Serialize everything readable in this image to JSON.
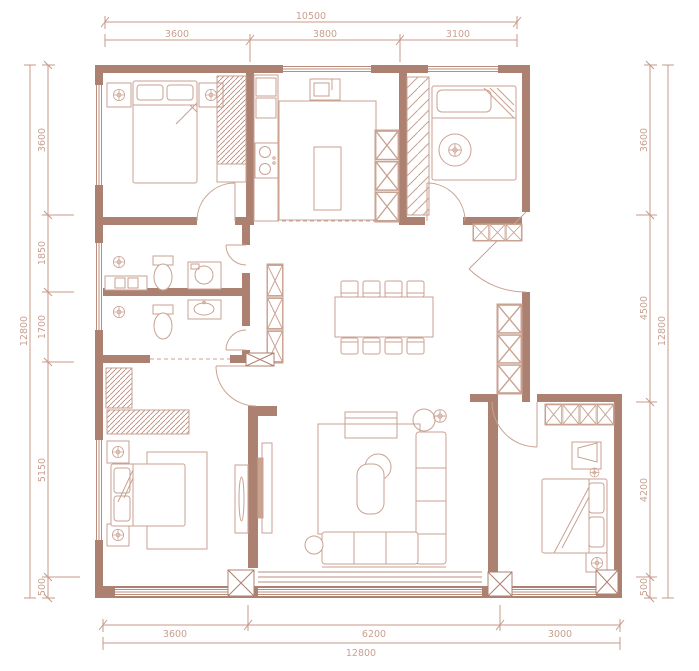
{
  "palette": {
    "wall_color": "#ad8172",
    "furniture_line_color": "#c9a292",
    "dimension_line_color": "#c49a8a",
    "dimension_text_color": "#c9a090",
    "background": "#ffffff"
  },
  "dimensions": {
    "top": {
      "total": "10500",
      "segments": [
        "3600",
        "3800",
        "3100"
      ]
    },
    "bottom": {
      "total": "12800",
      "segments": [
        "3600",
        "6200",
        "3000"
      ]
    },
    "left": {
      "total": "12800",
      "segments": [
        "3600",
        "1850",
        "1700",
        "5150",
        "500"
      ]
    },
    "right": {
      "total": "12800",
      "segments": [
        "3600",
        "4500",
        "4200",
        "500"
      ]
    }
  }
}
